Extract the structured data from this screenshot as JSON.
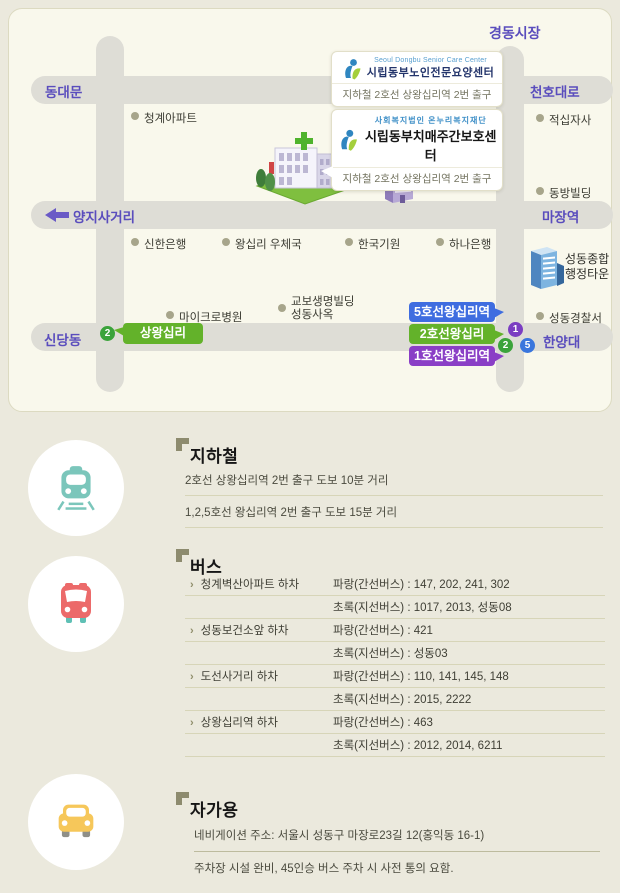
{
  "map": {
    "market_label": "경동시장",
    "road_labels": {
      "top_left": "동대문",
      "top_right": "천호대로",
      "mid_left": "양지사거리",
      "mid_right": "마장역",
      "bottom_left": "신당동",
      "bottom_right": "한양대"
    },
    "pois": [
      {
        "label": "청계아파트"
      },
      {
        "label": "적십자사"
      },
      {
        "label": "동방빌딩"
      },
      {
        "label": "신한은행"
      },
      {
        "label": "왕십리 우체국"
      },
      {
        "label": "한국기원"
      },
      {
        "label": "하나은행"
      },
      {
        "label": "마이크로병원"
      },
      {
        "label": "교보생명빌딩",
        "label2": "성동사옥"
      },
      {
        "label": "성동경찰서"
      }
    ],
    "buildings": {
      "health_center": {
        "label": "성동보건소"
      },
      "admin_town": {
        "label1": "성동종합",
        "label2": "행정타운"
      }
    },
    "info_boxes": [
      {
        "en": "Seoul Dongbu Senior Care Center",
        "title": "시립동부노인전문요양센터",
        "subtitle": "지하철 2호선 상왕십리역 2번 출구"
      },
      {
        "en": "사회복지법인  온누리복지재단",
        "title": "시립동부치매주간보호센터",
        "subtitle": "지하철 2호선 상왕십리역 2번 출구"
      }
    ],
    "stations": {
      "line5_badge": {
        "label": "5호선왕십리역",
        "color": "#3f6de0"
      },
      "line2_badge": {
        "label": "2호선왕십리",
        "color": "#63b22a"
      },
      "line1_badge": {
        "label": "1호선왕십리역",
        "color": "#8a3fc6"
      },
      "sangwangsimni_badge": {
        "label": "상왕십리",
        "color": "#63b22a"
      },
      "circles": [
        {
          "num": "1",
          "color": "#7b3ec2"
        },
        {
          "num": "2",
          "color": "#3ba33b"
        },
        {
          "num": "5",
          "color": "#3a76dd"
        }
      ]
    }
  },
  "sections": {
    "subway": {
      "title": "지하철",
      "lines": [
        "2호선 상왕십리역 2번 출구 도보 10분 거리",
        "1,2,5호선 왕십리역 2번 출구 도보 15분 거리"
      ]
    },
    "bus": {
      "title": "버스",
      "arrow_glyph": "›",
      "rows": [
        {
          "stop": "청계벽산아파트 하차",
          "info": "파랑(간선버스) : 147, 202, 241, 302"
        },
        {
          "stop": "",
          "info": "초록(지선버스) : 1017, 2013, 성동08"
        },
        {
          "stop": "성동보건소앞 하차",
          "info": "파랑(간선버스) : 421"
        },
        {
          "stop": "",
          "info": "초록(지선버스) : 성동03"
        },
        {
          "stop": "도선사거리 하차",
          "info": "파랑(간선버스) : 110, 141, 145, 148"
        },
        {
          "stop": "",
          "info": "초록(지선버스) : 2015, 2222"
        },
        {
          "stop": "상왕십리역 하차",
          "info": "파랑(간선버스) : 463"
        },
        {
          "stop": "",
          "info": "초록(지선버스) : 2012, 2014, 6211"
        }
      ]
    },
    "car": {
      "title": "자가용",
      "lines": [
        "네비게이션 주소: 서울시 성동구 마장로23길 12(홍익동 16-1)",
        "주차장 시설 완비, 45인승 버스 주차 시 사전 통의 요함."
      ]
    }
  },
  "colors": {
    "page_bg": "#ebe9dd",
    "map_bg": "#f9f8ec",
    "road": "#deddd6",
    "road_label": "#5a4dbd",
    "train_icon": "#7bc6bb",
    "bus_icon": "#ec6a6a",
    "car_icon": "#f6c75a"
  }
}
